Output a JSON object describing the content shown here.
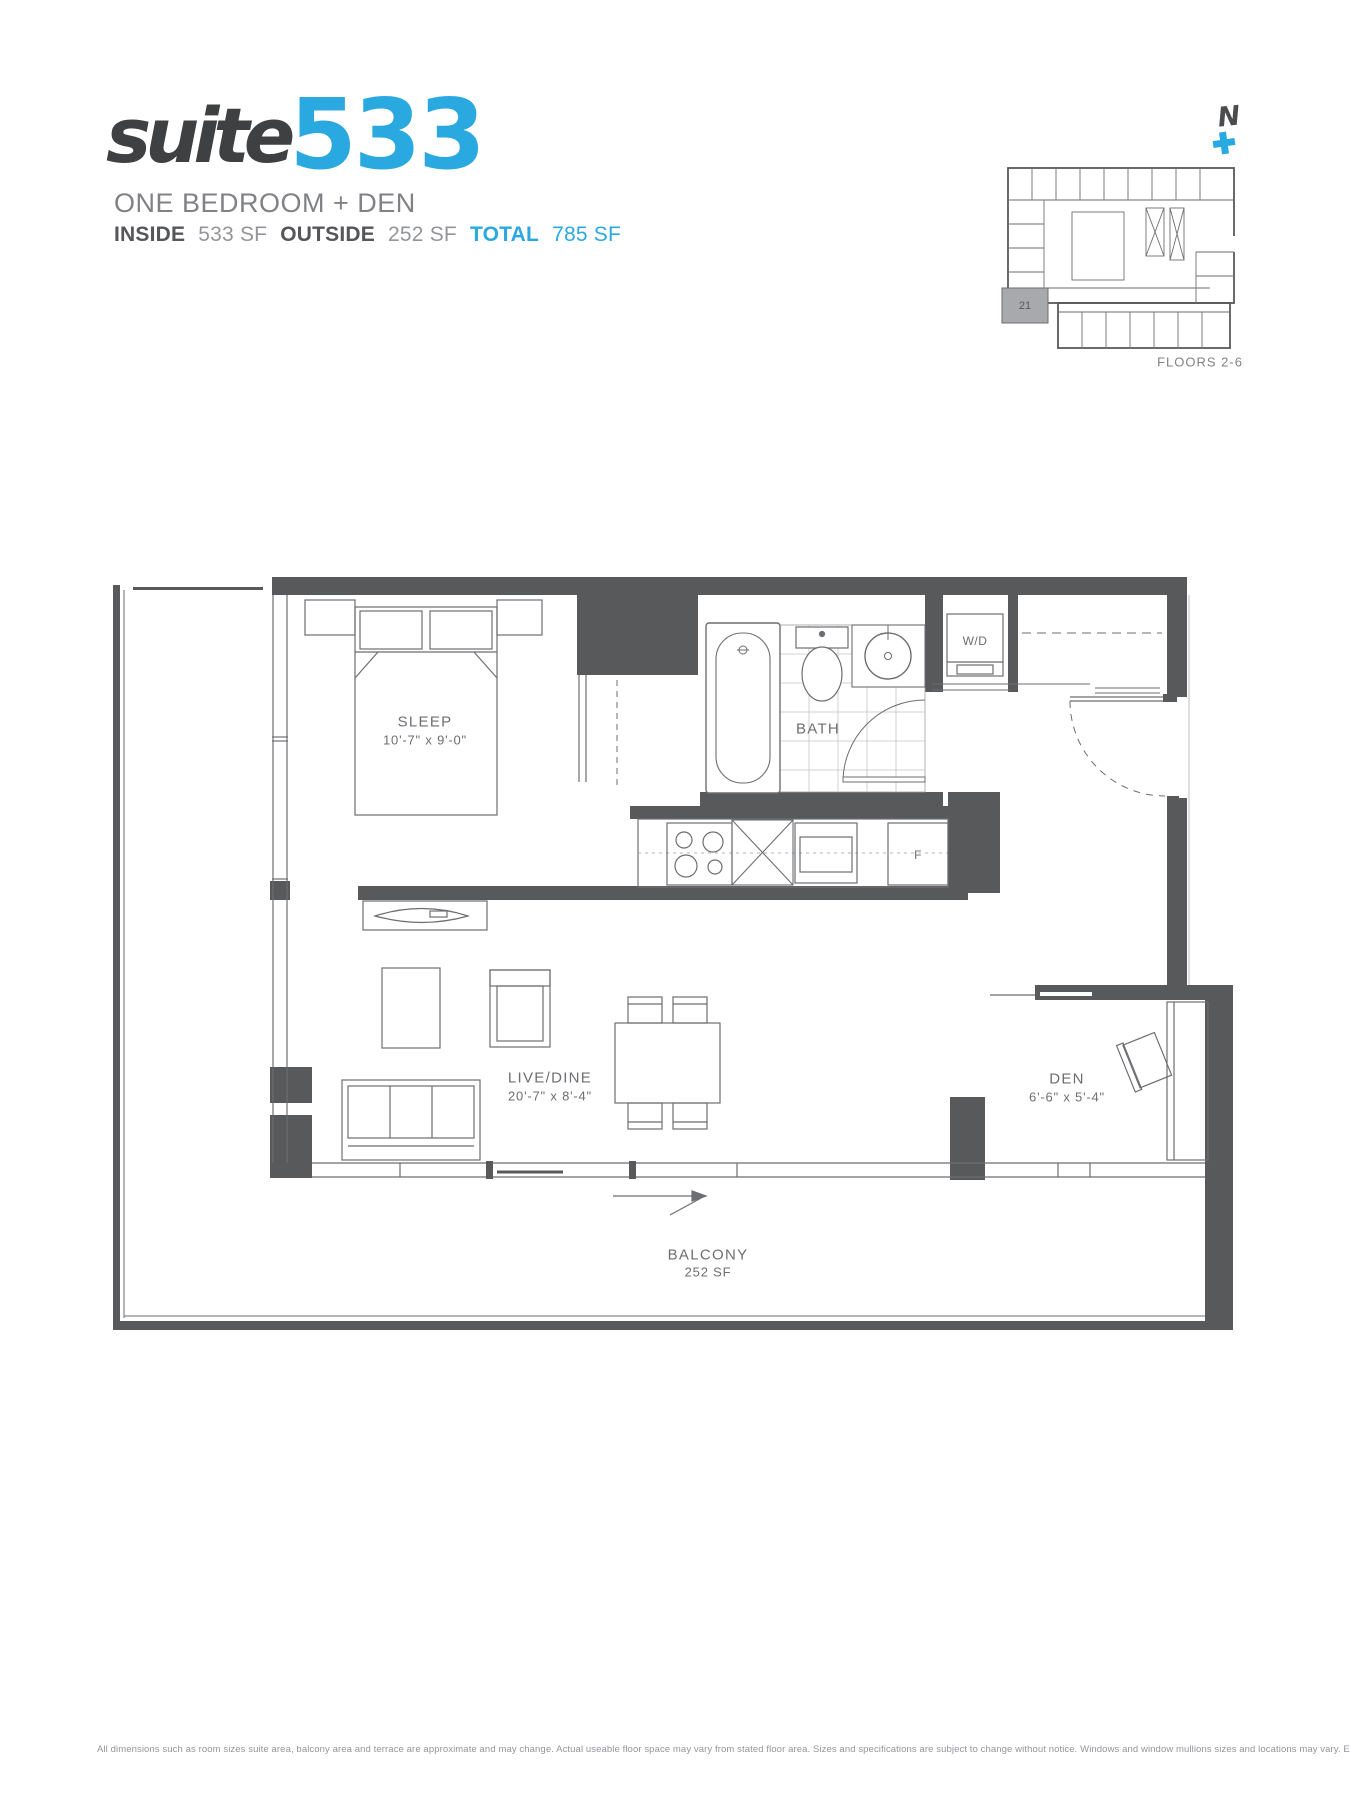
{
  "header": {
    "suite_word": "suite",
    "suite_number": "533",
    "subtitle": "ONE BEDROOM + DEN",
    "stats": {
      "inside_label": "INSIDE",
      "inside_value": "533 SF",
      "outside_label": "OUTSIDE",
      "outside_value": "252 SF",
      "total_label": "TOTAL",
      "total_value": "785 SF"
    }
  },
  "keyplan": {
    "north_label": "N",
    "unit_label": "21",
    "floors_label": "FLOORS 2-6"
  },
  "rooms": {
    "sleep": {
      "name": "SLEEP",
      "dims": "10'-7\" x 9'-0\""
    },
    "bath": {
      "name": "BATH"
    },
    "laundry": {
      "name": "W/D"
    },
    "fridge": {
      "name": "F"
    },
    "livedine": {
      "name": "LIVE/DINE",
      "dims": "20'-7\" x 8'-4\""
    },
    "den": {
      "name": "DEN",
      "dims": "6'-6\" x 5'-4\""
    },
    "balcony": {
      "name": "BALCONY",
      "area": "252 SF"
    }
  },
  "footer": {
    "disclaimer": "All dimensions such as room sizes suite area, balcony area and terrace are approximate and may change. Actual useable floor space may vary from stated floor area. Sizes and specifications are subject to change without notice. Windows and window mullions sizes and locations may vary. E. & O. E."
  },
  "colors": {
    "accent_blue": "#29A9E0",
    "wall_gray": "#58595B",
    "line_gray": "#6D6E71",
    "text_gray": "#808285",
    "keyplan_highlight": "#A7A9AC"
  }
}
